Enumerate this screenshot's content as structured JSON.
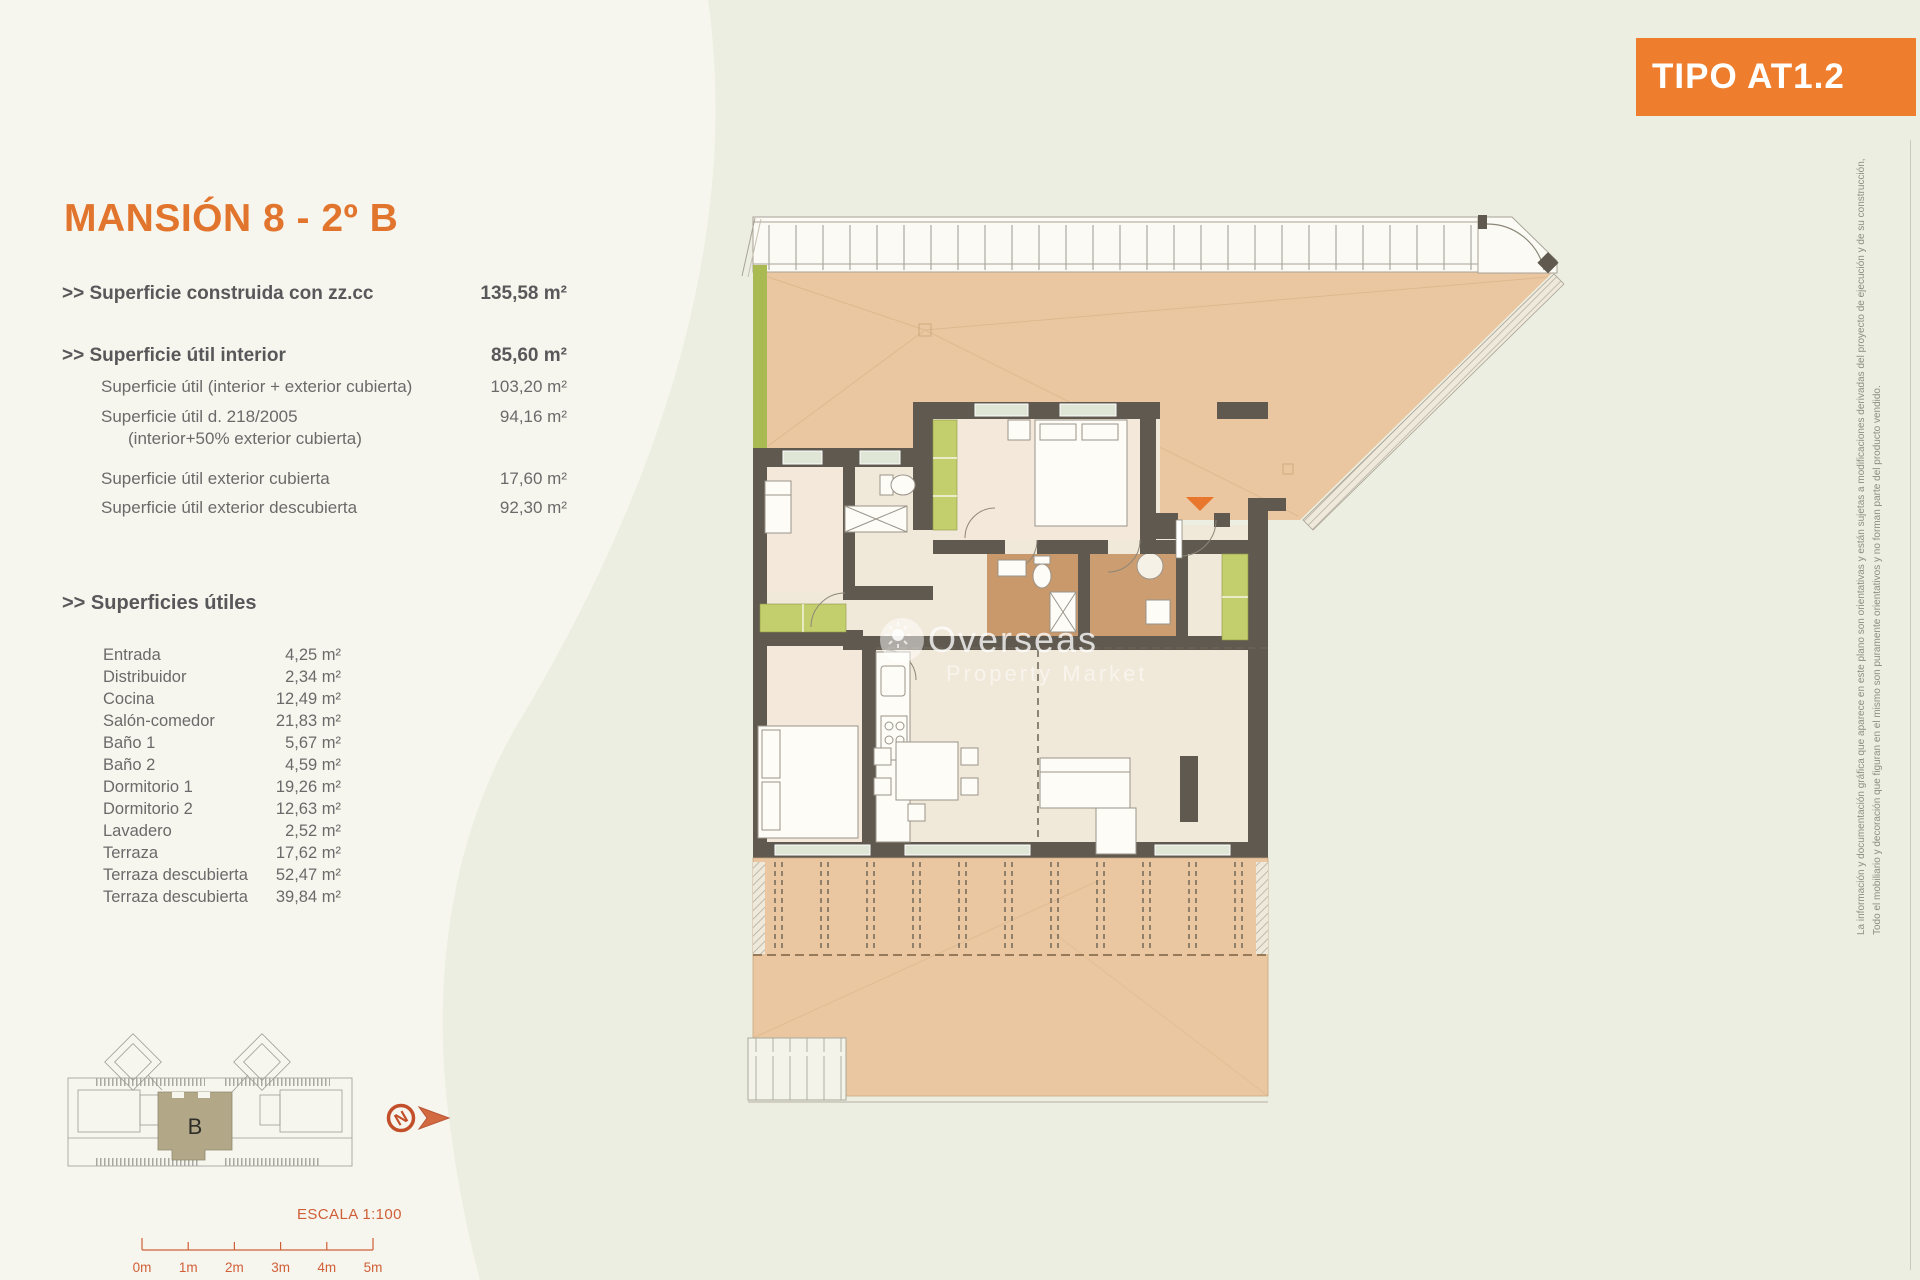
{
  "badge": {
    "label": "TIPO AT1.2"
  },
  "title": "MANSIÓN 8 - 2º B",
  "summary": {
    "rows": [
      {
        "label": ">> Superficie construida con zz.cc",
        "value": "135,58 m²"
      },
      {
        "label": ">> Superficie útil interior",
        "value": "85,60 m²"
      },
      {
        "label": "Superficie útil (interior + exterior cubierta)",
        "value": "103,20 m²"
      },
      {
        "label": "Superficie útil  d. 218/2005",
        "sub": "(interior+50% exterior cubierta)",
        "value": "94,16 m²"
      },
      {
        "label": "Superficie útil exterior cubierta",
        "value": "17,60 m²"
      },
      {
        "label": "Superficie útil exterior descubierta",
        "value": "92,30 m²"
      }
    ]
  },
  "rooms": {
    "header": ">> Superficies útiles",
    "rows": [
      {
        "label": "Entrada",
        "value": "4,25 m²"
      },
      {
        "label": "Distribuidor",
        "value": "2,34 m²"
      },
      {
        "label": "Cocina",
        "value": "12,49 m²"
      },
      {
        "label": "Salón-comedor",
        "value": "21,83 m²"
      },
      {
        "label": "Baño 1",
        "value": "5,67 m²"
      },
      {
        "label": "Baño 2",
        "value": "4,59 m²"
      },
      {
        "label": "Dormitorio 1",
        "value": "19,26 m²"
      },
      {
        "label": "Dormitorio 2",
        "value": "12,63 m²"
      },
      {
        "label": "Lavadero",
        "value": "2,52 m²"
      },
      {
        "label": "Terraza",
        "value": "17,62 m²"
      },
      {
        "label": "Terraza descubierta",
        "value": "52,47 m²"
      },
      {
        "label": "Terraza descubierta",
        "value": "39,84 m²"
      }
    ]
  },
  "site_plan": {
    "block_label": "B"
  },
  "compass": {
    "letter": "N"
  },
  "scale_bar": {
    "label": "ESCALA 1:100",
    "ticks": [
      "0m",
      "1m",
      "2m",
      "3m",
      "4m",
      "5m"
    ]
  },
  "watermark": {
    "line1": "Overseas",
    "line2": "Property Market"
  },
  "disclaimer": {
    "line1": "La información y documentación gráfica que aparece en este plano son orientativas y están sujetas a modificaciones derivadas del proyecto de ejecución y de su construcción,",
    "line2": "Todo el mobiliario y decoración que figuran en el mismo son puramente orientativos y no forman parte del producto vendido."
  },
  "colors": {
    "accent_orange": "#ee7e2e",
    "title_orange": "#e2752d",
    "wall": "#5f594f",
    "terrace_tan": "#eac7a0",
    "bath_brown": "#c9996b",
    "wardrobe_olive": "#c3ce6d",
    "scale_red": "#cf5f38",
    "site_khaki": "#b2a888"
  }
}
